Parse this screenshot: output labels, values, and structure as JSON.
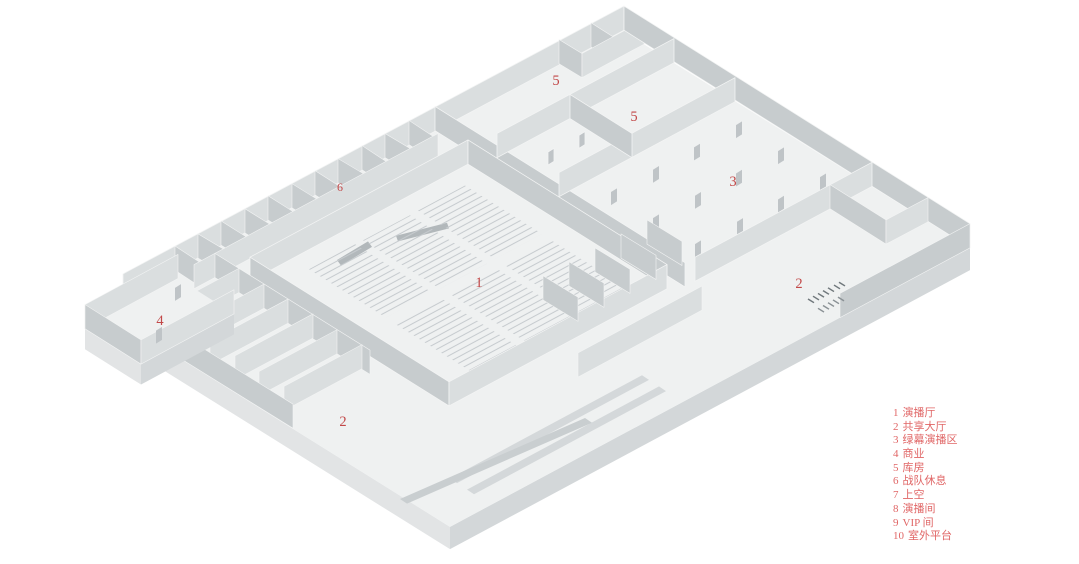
{
  "plan": {
    "description_markers": [
      {
        "num": "5"
      },
      {
        "num": "5"
      },
      {
        "num": "6"
      },
      {
        "num": "3"
      },
      {
        "num": "1"
      },
      {
        "num": "2"
      },
      {
        "num": "4"
      },
      {
        "num": "2"
      }
    ]
  },
  "legend": {
    "items": [
      {
        "num": "1",
        "label": "演播厅"
      },
      {
        "num": "2",
        "label": "共享大厅"
      },
      {
        "num": "3",
        "label": "绿幕演播区"
      },
      {
        "num": "4",
        "label": "商业"
      },
      {
        "num": "5",
        "label": "库房"
      },
      {
        "num": "6",
        "label": "战队休息"
      },
      {
        "num": "7",
        "label": "上空"
      },
      {
        "num": "8",
        "label": "演播间"
      },
      {
        "num": "9",
        "label": "VIP 间"
      },
      {
        "num": "10",
        "label": "室外平台"
      }
    ]
  },
  "colors": {
    "marker_red": "#c24848",
    "legend_red": "#e06666",
    "floor": "#eff1f1",
    "wall_light": "#dadedf",
    "wall_dark": "#c7ccce",
    "background": "#ffffff"
  }
}
